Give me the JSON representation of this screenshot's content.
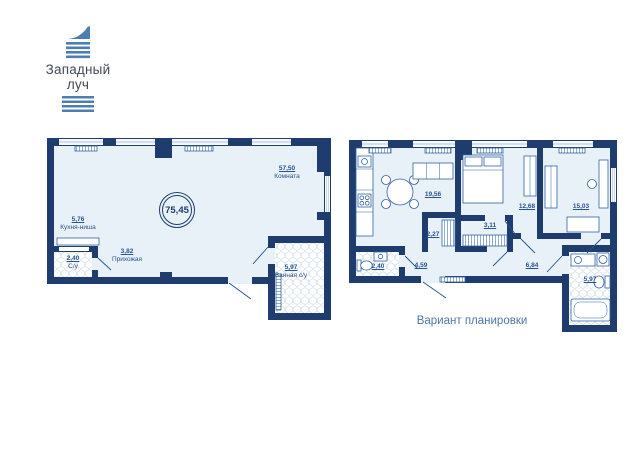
{
  "logo": {
    "line1": "Западный",
    "line2": "луч"
  },
  "left_plan": {
    "total_area": "75,45",
    "rooms": [
      {
        "area": "57,50",
        "label": "Комната"
      },
      {
        "area": "5,76",
        "label": "Кухня-ниша"
      },
      {
        "area": "2,40",
        "label": "С/у"
      },
      {
        "area": "3,82",
        "label": "Прихожая"
      },
      {
        "area": "5,97",
        "label": "Ванная с/у"
      }
    ]
  },
  "right_plan": {
    "caption": "Вариант планировки",
    "rooms": [
      {
        "area": "19,56"
      },
      {
        "area": "12,68"
      },
      {
        "area": "15,03"
      },
      {
        "area": "2,27"
      },
      {
        "area": "3,11"
      },
      {
        "area": "2,40"
      },
      {
        "area": "4,59"
      },
      {
        "area": "6,84"
      },
      {
        "area": "5,97"
      }
    ]
  },
  "colors": {
    "wall": "#1e3d6e",
    "floor": "#e9f1f8",
    "label_text": "#27538f",
    "caption_text": "#4d77a6",
    "logo_blue": "#4d7eb2"
  }
}
